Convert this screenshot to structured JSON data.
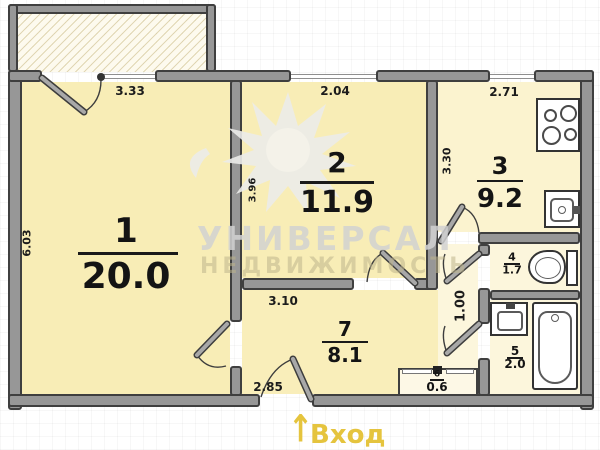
{
  "plan": {
    "watermark": {
      "title": "УНИВЕРСАЛ",
      "subtitle": "НЕДВИЖИМОСТЬ",
      "logo": "sun-watermark-icon"
    },
    "entrance": {
      "label": "Вход",
      "arrow_glyph": "↑"
    },
    "rooms": [
      {
        "number": "1",
        "area": "20.0",
        "type": "living-room"
      },
      {
        "number": "2",
        "area": "11.9",
        "type": "bedroom"
      },
      {
        "number": "3",
        "area": "9.2",
        "type": "kitchen"
      },
      {
        "number": "4",
        "area": "1.7",
        "type": "toilet"
      },
      {
        "number": "5",
        "area": "2.0",
        "type": "bathroom"
      },
      {
        "number": "6",
        "area": "0.6",
        "type": "closet"
      },
      {
        "number": "7",
        "area": "8.1",
        "type": "hallway"
      }
    ],
    "dimensions": {
      "room1_width": "3.33",
      "room1_depth": "6.03",
      "room2_width": "2.04",
      "room2_depth": "3.96",
      "kitchen_width": "2.71",
      "kitchen_depth": "3.30",
      "hall_top_width": "3.10",
      "hall_bottom_width": "2.85",
      "corridor_width": "1.00"
    },
    "colors": {
      "accent_gold": "#e5c43e",
      "room_fill": "#f8edb6",
      "kitchen_fill": "#fbf3cf",
      "wet_room_fill": "#fcf6dc",
      "wall_gray": "#979797",
      "wall_outline": "#3f3f3f",
      "watermark_gray": "#d2d2d2"
    },
    "icons": {
      "stove": "stove-icon",
      "kitchen_sink": "kitchen-sink-icon",
      "toilet": "toilet-icon",
      "bath_sink": "bath-sink-icon",
      "bathtub": "bathtub-icon",
      "entrance_arrow": "entrance-arrow-icon"
    }
  }
}
